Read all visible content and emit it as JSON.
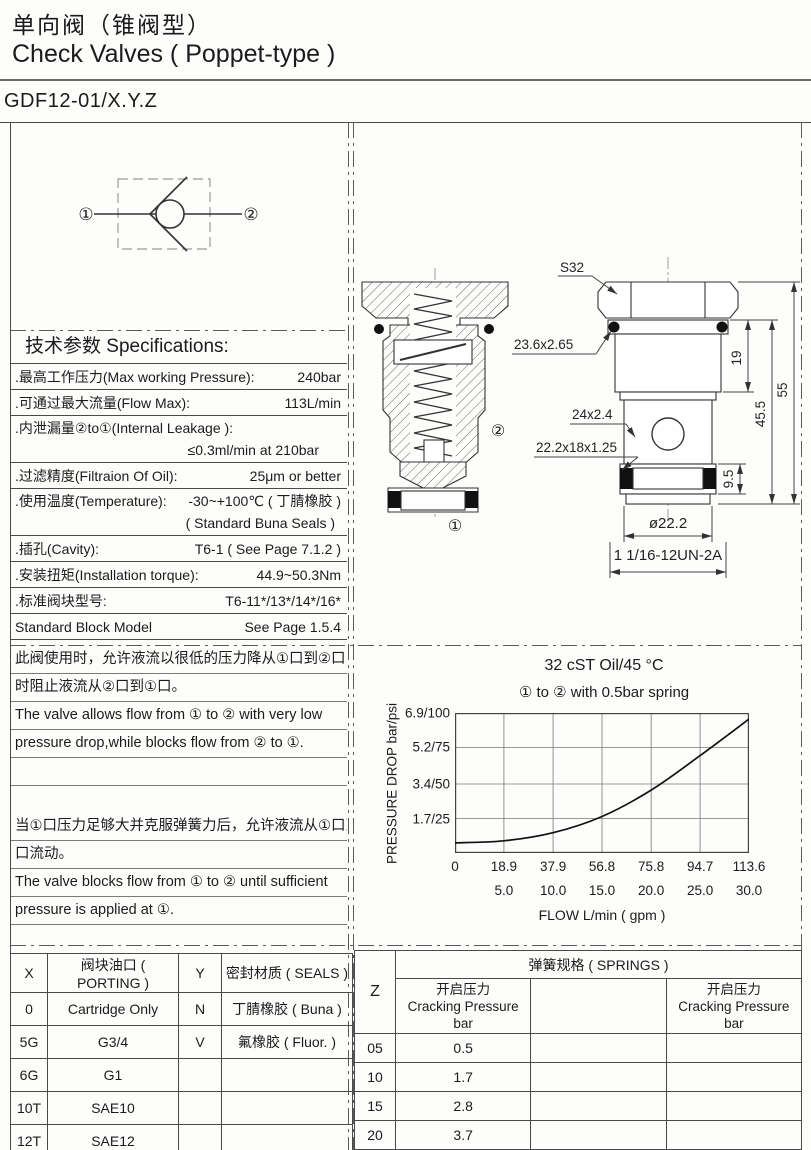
{
  "header": {
    "title_zh": "单向阀（锥阀型）",
    "title_en": "Check Valves ( Poppet-type )",
    "model": "GDF12-01/X.Y.Z"
  },
  "symbol": {
    "port1": "①",
    "port2": "②"
  },
  "specs": {
    "heading": "技术参数  Specifications:",
    "rows": [
      {
        "label": ".最高工作压力(Max working Pressure):",
        "value": "240bar"
      },
      {
        "label": ".可通过最大流量(Flow Max):",
        "value": "113L/min"
      },
      {
        "label": ".内泄漏量②to①(Internal Leakage ):",
        "value": "",
        "value2": "≤0.3ml/min at 210bar"
      },
      {
        "label": ".过滤精度(Filtraion Of Oil):",
        "value": "25μm or better"
      },
      {
        "label": ".使用温度(Temperature):",
        "value": "-30~+100℃ ( 丁腈橡胶 )",
        "value2": "( Standard Buna Seals )"
      },
      {
        "label": ".插孔(Cavity):",
        "value": "T6-1 ( See Page 7.1.2 )"
      },
      {
        "label": ".安装扭矩(Installation torque):",
        "value": "44.9~50.3Nm"
      },
      {
        "label": ".标准阀块型号:",
        "value": "T6-11*/13*/14*/16*"
      },
      {
        "label": "Standard Block Model",
        "value": "See Page 1.5.4"
      }
    ]
  },
  "description": {
    "lines": [
      "此阀使用时，允许液流以很低的压力降从①口到②口，同",
      "时阻止液流从②口到①口。",
      "The valve allows flow from ① to ② with very low",
      "pressure drop,while blocks flow from ② to ①.",
      "",
      "",
      "当①口压力足够大并克服弹簧力后，允许液流从①口到②",
      "口流动。",
      "The valve blocks flow from ① to ② until sufficient",
      "pressure is applied at ①.",
      ""
    ]
  },
  "drawing": {
    "labels": {
      "wrench": "S32",
      "oring_top": "23.6x2.65",
      "backup": "24x2.4",
      "seal": "22.2x18x1.25",
      "dim19": "19",
      "dim455": "45.5",
      "dim55": "55",
      "dim95": "9.5",
      "dia": "ø22.2",
      "thread": "1 1/16-12UN-2A",
      "port1": "①",
      "port2": "②"
    }
  },
  "chart_data": {
    "type": "line",
    "title": "32 cST Oil/45 °C",
    "subtitle": "①  to ② with 0.5bar spring",
    "ylabel": "PRESSURE DROP  bar/psi",
    "xlabel": "FLOW L/min ( gpm )",
    "xlim": [
      0,
      113.6
    ],
    "ylim": [
      0,
      6.9
    ],
    "grid": true,
    "x_lmin": [
      0,
      18.9,
      37.9,
      56.8,
      75.8,
      94.7,
      113.6
    ],
    "x_ticks_lmin": [
      "0",
      "18.9",
      "37.9",
      "56.8",
      "75.8",
      "94.7",
      "113.6"
    ],
    "x_ticks_gpm": [
      "5.0",
      "10.0",
      "15.0",
      "20.0",
      "25.0",
      "30.0"
    ],
    "y_ticks": [
      "6.9/100",
      "5.2/75",
      "3.4/50",
      "1.7/25"
    ],
    "y_tick_values": [
      6.9,
      5.2,
      3.4,
      1.7
    ],
    "series": [
      {
        "name": "pressure drop 1 to 2",
        "x": [
          0,
          18.9,
          37.9,
          56.8,
          75.8,
          94.7,
          113.6
        ],
        "y": [
          0.5,
          0.6,
          1.0,
          1.8,
          3.1,
          4.8,
          6.6
        ]
      }
    ]
  },
  "porting_table": {
    "headers": [
      "X",
      "阀块油口 ( PORTING )",
      "Y",
      "密封材质 ( SEALS )"
    ],
    "rows": [
      [
        "0",
        "Cartridge Only",
        "N",
        "丁腈橡胶 ( Buna )"
      ],
      [
        "5G",
        "G3/4",
        "V",
        "氟橡胶 ( Fluor. )"
      ],
      [
        "6G",
        "G1",
        "",
        ""
      ],
      [
        "10T",
        "SAE10",
        "",
        ""
      ],
      [
        "12T",
        "SAE12",
        "",
        ""
      ]
    ]
  },
  "springs_table": {
    "z_header": "Z",
    "title": "弹簧规格 ( SPRINGS )",
    "col_header_zh": "开启压力",
    "col_header_en": "Cracking Pressure",
    "col_header_unit": "bar",
    "rows": [
      [
        "05",
        "0.5"
      ],
      [
        "10",
        "1.7"
      ],
      [
        "15",
        "2.8"
      ],
      [
        "20",
        "3.7"
      ]
    ]
  }
}
